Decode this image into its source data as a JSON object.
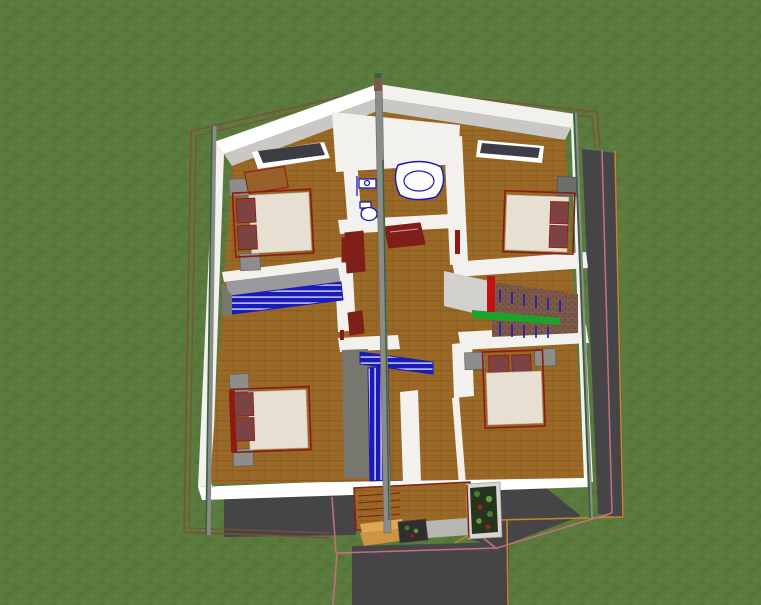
{
  "scene": {
    "title": "aerial-3d-floor-plan-render",
    "view": "top-down-3d-perspective",
    "rooms": [
      {
        "name": "bedroom-top-left",
        "objects": [
          "double-bed",
          "pillows",
          "nightstand",
          "nightstand",
          "wood-dresser",
          "window"
        ]
      },
      {
        "name": "bathroom-top-center",
        "objects": [
          "corner-bathtub",
          "sink",
          "toilet",
          "red-cabinet"
        ]
      },
      {
        "name": "bedroom-top-right",
        "objects": [
          "double-bed",
          "pillows",
          "nightstand",
          "window"
        ]
      },
      {
        "name": "landing-left",
        "objects": [
          "blue-louver-railing"
        ]
      },
      {
        "name": "hallway-center",
        "objects": [
          "red-console-table",
          "red-wardrobe",
          "center-pole"
        ]
      },
      {
        "name": "staircase-right",
        "objects": [
          "carpet-steps",
          "green-handrail",
          "blue-balusters",
          "red-newel-post"
        ]
      },
      {
        "name": "stairwell-center",
        "objects": [
          "blue-louver-railing",
          "floor-opening"
        ]
      },
      {
        "name": "bedroom-bottom-left",
        "objects": [
          "double-bed",
          "pillows",
          "nightstand",
          "nightstand"
        ]
      },
      {
        "name": "bedroom-bottom-right",
        "objects": [
          "double-bed",
          "pillows",
          "nightstand",
          "nightstand"
        ]
      },
      {
        "name": "entrance-porch",
        "objects": [
          "wood-deck",
          "tan-steps",
          "flower-box",
          "stone-path",
          "tall-planter"
        ]
      }
    ],
    "exterior": [
      "lawn",
      "roof-plan-outline",
      "driveway",
      "side-shadow-strip",
      "corner-posts"
    ]
  },
  "colors": {
    "grass": "#5b7a3e",
    "grass_dark": "#517038",
    "grass_light": "#648347",
    "outline_brown": "#7d5138",
    "outline_orange": "#c8862c",
    "outline_pink": "#c4707e",
    "wall_white": "#f2f1ee",
    "wall_bright": "#ffffff",
    "wall_gray": "#d2d1cd",
    "wall_mid_gray": "#9a999c",
    "ceiling_gray": "#c9c8c4",
    "floor_wood": "#9a6827",
    "floor_wood_dark": "#7e5316",
    "shadow_gray": "#454548",
    "stairwell_gray": "#77766f",
    "pole_gray": "#8b8b88",
    "post_green": "#37623f",
    "fixture_blue": "#1a1ab8",
    "louver_stripe": "#d9d9f2",
    "rail_green": "#1ca32a",
    "stair_carpet": "#7b584a",
    "stair_carpet_dot": "#684736",
    "bed_mattress": "#e6dfd2",
    "bed_pillow": "#7d4343",
    "bed_frame_red": "#8e1a12",
    "nightstand_gray": "#8e8d8b",
    "nightstand_dark": "#6f6e6c",
    "newel_red": "#c01410",
    "deck_wood": "#96622a",
    "step_tan": "#dda757",
    "step_tan_dark": "#cf9441",
    "planter_frame": "#d8d6d0",
    "planter_soil": "#24341e",
    "foliage_green": "#4a7a30",
    "foliage_light": "#6a9a40",
    "berry_red": "#a32020",
    "window_dark": "#3c3c44",
    "path_gray": "#b7b6b2",
    "table_red": "#7e1f1a"
  }
}
